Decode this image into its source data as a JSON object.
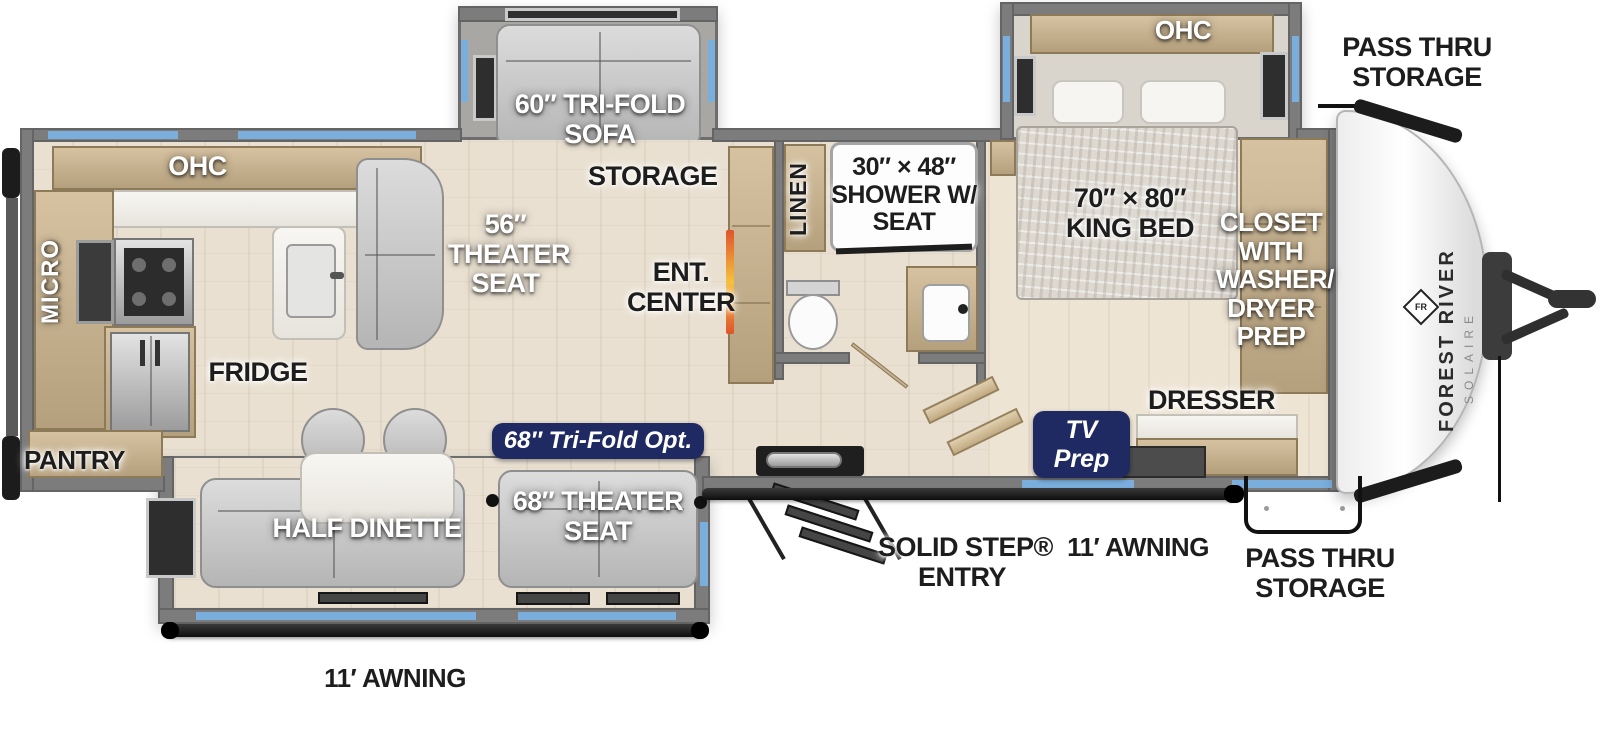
{
  "title": "Forest River Solaire fifth-wheel floor plan diagram",
  "colors": {
    "navy_badge": "#1f2a63",
    "accent_blue_window": "#7aaedc",
    "wall_gray": "#7c7c7c",
    "floor_wood": "#e9e0d1",
    "cabinet_tan": "#c6b190",
    "fireplace_orange": "#e0542a",
    "label_black": "#1d1d1d",
    "label_white": "#ffffff"
  },
  "brand": {
    "name": "FOREST RIVER",
    "model": "SOLAIRE",
    "logo": "FR"
  },
  "labels": {
    "kitchen_ohc": "OHC",
    "micro": "MICRO",
    "fridge": "FRIDGE",
    "pantry": "PANTRY",
    "theater_seat_56": [
      "56″",
      "THEATER",
      "SEAT"
    ],
    "tri_fold_sofa_60": [
      "60″ TRI-FOLD",
      "SOFA"
    ],
    "storage": "STORAGE",
    "ent_center": [
      "ENT.",
      "CENTER"
    ],
    "linen": "LINEN",
    "shower": [
      "30″ × 48″",
      "SHOWER W/",
      "SEAT"
    ],
    "bedroom_ohc": "OHC",
    "king_bed": [
      "70″ × 80″",
      "KING BED"
    ],
    "closet": [
      "CLOSET",
      "WITH",
      "WASHER/",
      "DRYER",
      "PREP"
    ],
    "dresser": "DRESSER",
    "tv_prep": [
      "TV",
      "Prep"
    ],
    "tri_fold_opt_68": "68″ Tri-Fold Opt.",
    "half_dinette": "HALF DINETTE",
    "theater_seat_68": [
      "68″ THEATER",
      "SEAT"
    ],
    "solid_step_entry": [
      "SOLID STEP®",
      "ENTRY"
    ],
    "awning_entry_side": "11′ AWNING",
    "awning_rear_side": "11′ AWNING",
    "pass_thru_top": [
      "PASS THRU",
      "STORAGE"
    ],
    "pass_thru_bottom": [
      "PASS THRU",
      "STORAGE"
    ]
  }
}
